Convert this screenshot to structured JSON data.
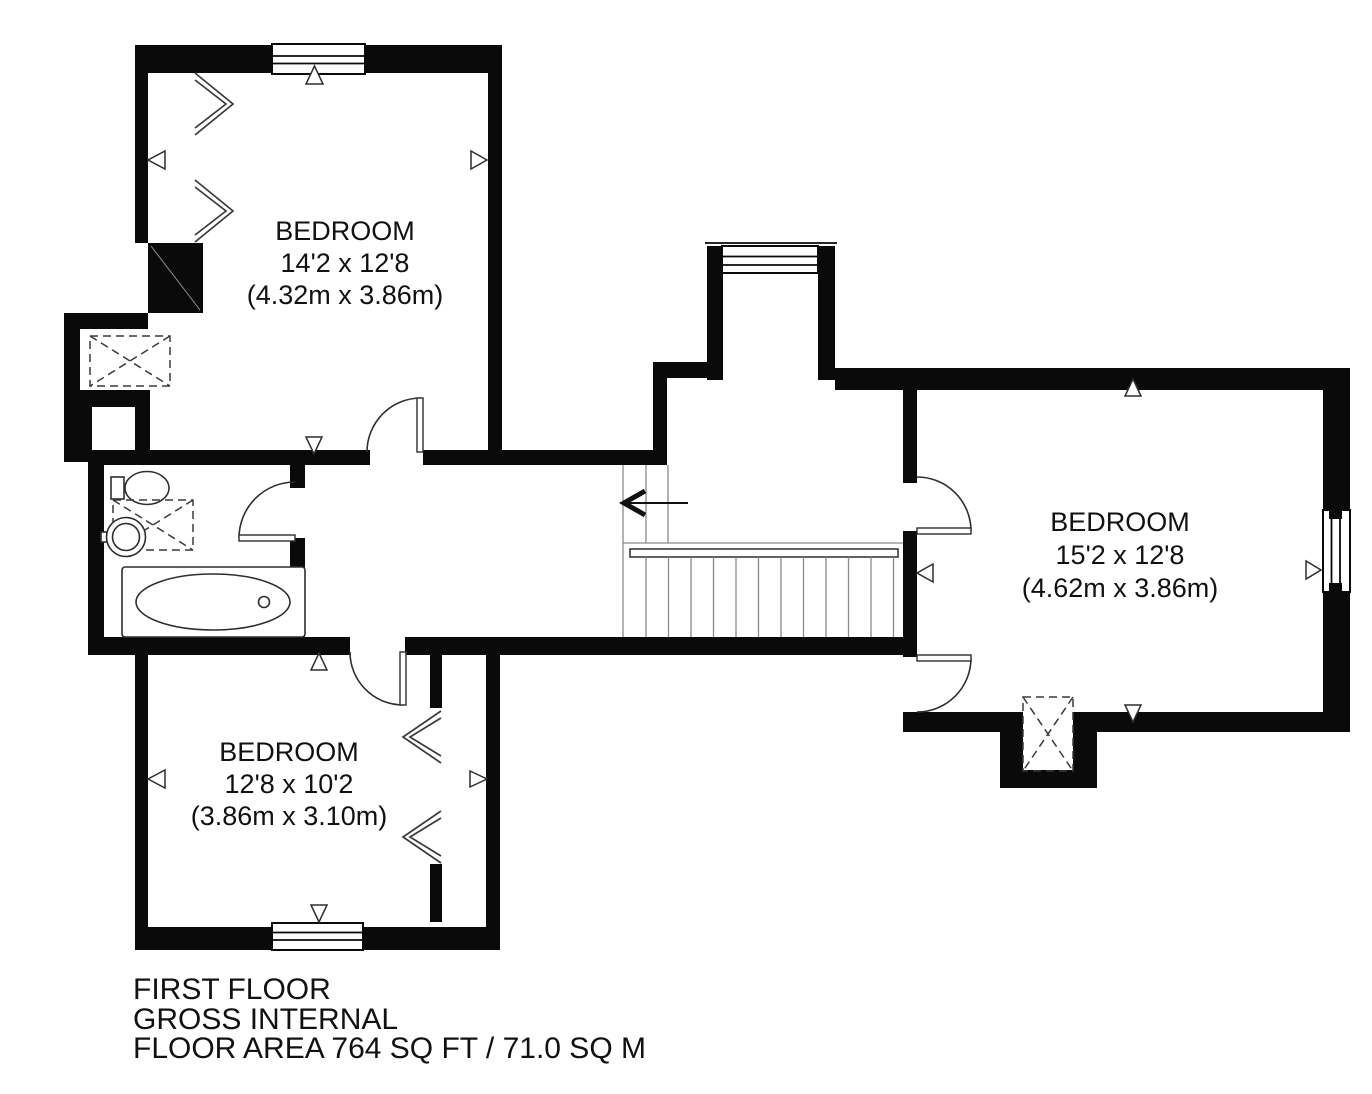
{
  "plan": {
    "floor_name": "FIRST FLOOR",
    "rooms": [
      {
        "id": "bedroom-top-left",
        "name": "BEDROOM",
        "size_imperial": "14'2 x 12'8",
        "size_metric": "(4.32m x 3.86m)"
      },
      {
        "id": "bedroom-bottom-left",
        "name": "BEDROOM",
        "size_imperial": "12'8 x 10'2",
        "size_metric": "(3.86m x 3.10m)"
      },
      {
        "id": "bedroom-right",
        "name": "BEDROOM",
        "size_imperial": "15'2 x 12'8",
        "size_metric": "(4.62m x 3.86m)"
      }
    ],
    "footer": [
      "FIRST FLOOR",
      "GROSS INTERNAL",
      "FLOOR AREA 764 SQ FT / 71.0 SQ M"
    ],
    "colors": {
      "wall": "#0a0a0a",
      "line": "#2e2e2e",
      "background": "#ffffff"
    }
  }
}
